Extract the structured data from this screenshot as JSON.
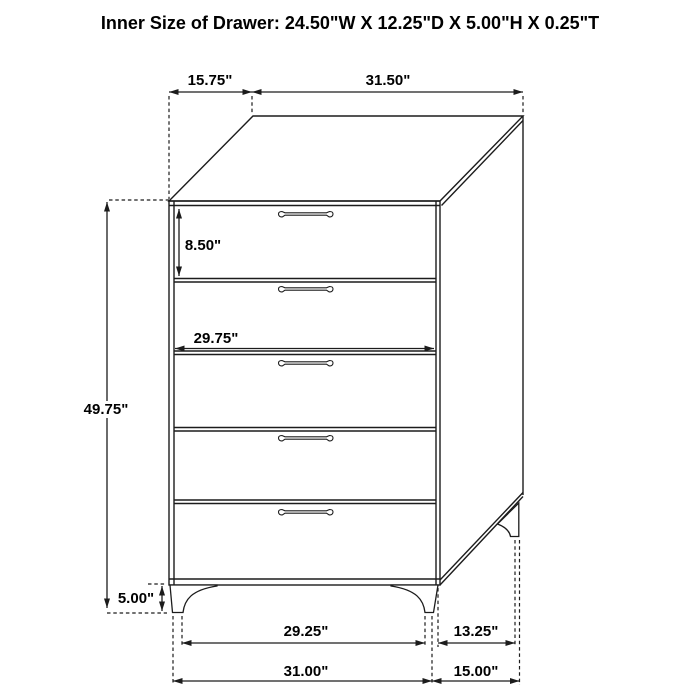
{
  "title": "Inner Size of Drawer: 24.50\"W X 12.25\"D X 5.00\"H X 0.25\"T",
  "drawing": {
    "subject": "five-drawer-chest-dimension-diagram",
    "drawer_count": 5,
    "colors": {
      "background": "#ffffff",
      "line": "#1c1c1c",
      "text": "#000000"
    },
    "dimensions": {
      "top_depth": "15.75\"",
      "top_width": "31.50\"",
      "overall_height": "49.75\"",
      "top_drawer_height": "8.50\"",
      "drawer_width": "29.75\"",
      "leg_height": "5.00\"",
      "front_foot_span": "29.25\"",
      "side_foot_span": "13.25\"",
      "overall_width": "31.00\"",
      "overall_depth": "15.00\""
    }
  }
}
